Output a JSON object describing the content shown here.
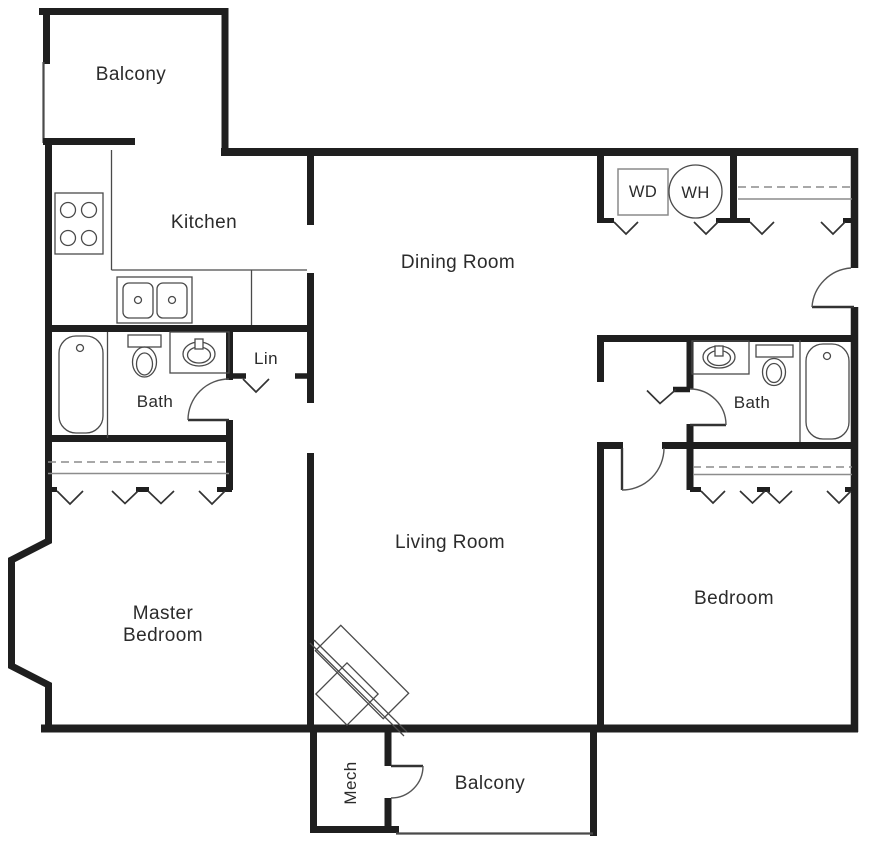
{
  "plan": {
    "rooms": {
      "balcony_top": "Balcony",
      "kitchen": "Kitchen",
      "dining_room": "Dining Room",
      "living_room": "Living Room",
      "master_bedroom_line1": "Master",
      "master_bedroom_line2": "Bedroom",
      "bedroom": "Bedroom",
      "bath_left": "Bath",
      "bath_right": "Bath",
      "linen_closet": "Lin",
      "mech_room": "Mech",
      "balcony_bottom": "Balcony"
    },
    "appliances": {
      "washer_dryer": "WD",
      "water_heater": "WH"
    },
    "colors": {
      "wall": "#1f1f1f",
      "fixture_outline": "#4a4a4a",
      "background": "#ffffff",
      "label_text": "#2b2b2b"
    },
    "fixtures": [
      "stove-icon",
      "kitchen-double-sink-icon",
      "bathtub-icon",
      "toilet-icon",
      "vanity-sink-icon",
      "corner-fireplace-icon",
      "closet-shelf-rod-icon",
      "door-swing-icon",
      "bifold-door-chevron-icon"
    ]
  }
}
